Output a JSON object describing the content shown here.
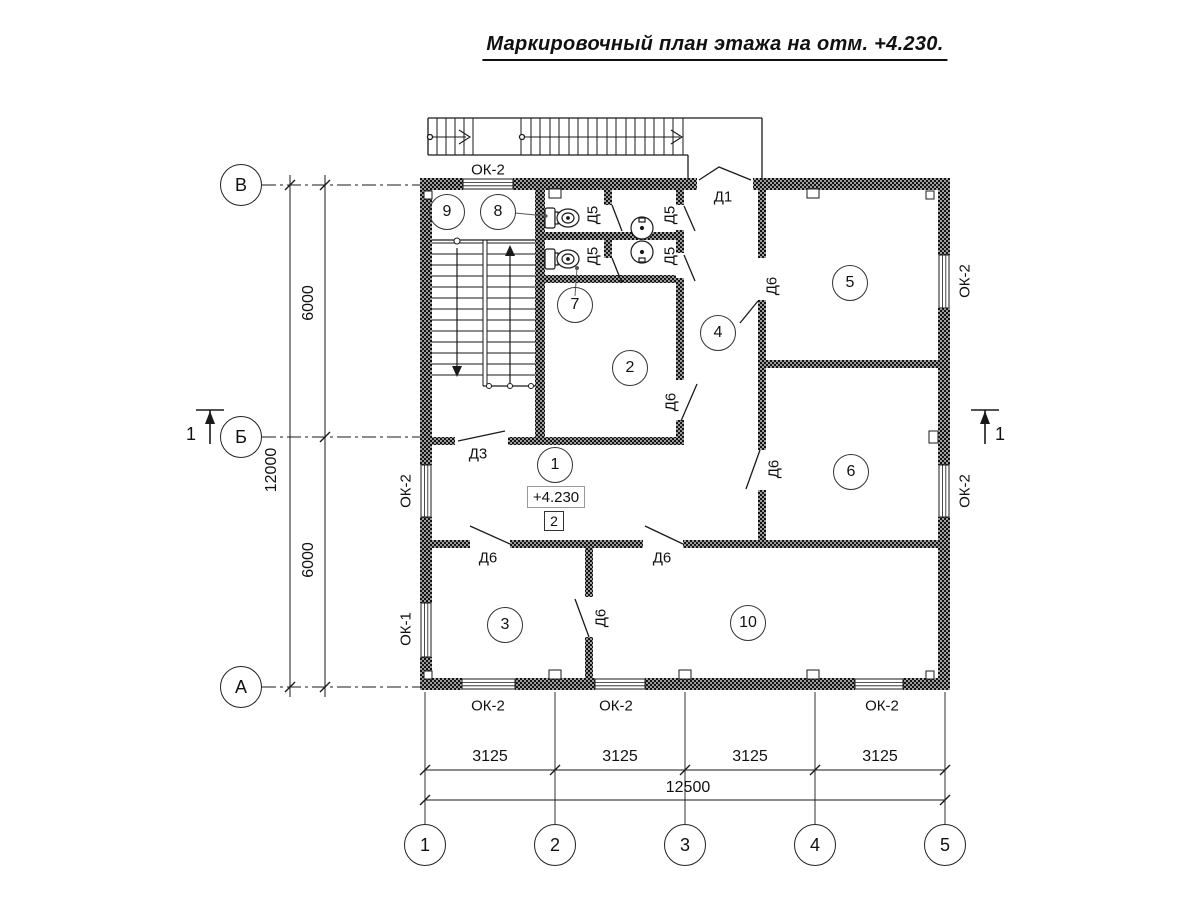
{
  "title": "Маркировочный план этажа на отм. +4.230.",
  "elevation_box": "+4.230",
  "zone_box": "2",
  "rooms": [
    {
      "name": "room-circle-1",
      "number": "1",
      "x": 555,
      "y": 465
    },
    {
      "name": "room-circle-2",
      "number": "2",
      "x": 630,
      "y": 368
    },
    {
      "name": "room-circle-3",
      "number": "3",
      "x": 505,
      "y": 625
    },
    {
      "name": "room-circle-4",
      "number": "4",
      "x": 718,
      "y": 333
    },
    {
      "name": "room-circle-5",
      "number": "5",
      "x": 850,
      "y": 283
    },
    {
      "name": "room-circle-6",
      "number": "6",
      "x": 851,
      "y": 472
    },
    {
      "name": "room-circle-7",
      "number": "7",
      "x": 575,
      "y": 305
    },
    {
      "name": "room-circle-8",
      "number": "8",
      "x": 498,
      "y": 212
    },
    {
      "name": "room-circle-9",
      "number": "9",
      "x": 447,
      "y": 212
    },
    {
      "name": "room-circle-10",
      "number": "10",
      "x": 748,
      "y": 623
    }
  ],
  "axes_left": [
    {
      "name": "axis-circle-v",
      "label": "В",
      "x": 241,
      "y": 185
    },
    {
      "name": "axis-circle-b",
      "label": "Б",
      "x": 241,
      "y": 437
    },
    {
      "name": "axis-circle-a",
      "label": "А",
      "x": 241,
      "y": 687
    }
  ],
  "axes_bottom": [
    {
      "name": "axis-circle-1",
      "label": "1",
      "x": 425,
      "y": 845
    },
    {
      "name": "axis-circle-2",
      "label": "2",
      "x": 555,
      "y": 845
    },
    {
      "name": "axis-circle-3",
      "label": "3",
      "x": 685,
      "y": 845
    },
    {
      "name": "axis-circle-4",
      "label": "4",
      "x": 815,
      "y": 845
    },
    {
      "name": "axis-circle-5",
      "label": "5",
      "x": 945,
      "y": 845
    }
  ],
  "labels": [
    {
      "name": "window-label-ok2-top",
      "text": "ОК-2",
      "x": 488,
      "y": 170,
      "rot": 0,
      "cls": ""
    },
    {
      "name": "window-label-ok2-left",
      "text": "ОК-2",
      "x": 406,
      "y": 491,
      "rot": -90,
      "cls": ""
    },
    {
      "name": "window-label-ok1-left",
      "text": "ОК-1",
      "x": 406,
      "y": 629,
      "rot": -90,
      "cls": ""
    },
    {
      "name": "window-label-ok2-right-upper",
      "text": "ОК-2",
      "x": 965,
      "y": 281,
      "rot": -90,
      "cls": ""
    },
    {
      "name": "window-label-ok2-right-lower",
      "text": "ОК-2",
      "x": 965,
      "y": 491,
      "rot": -90,
      "cls": ""
    },
    {
      "name": "window-label-ok2-bottom-1",
      "text": "ОК-2",
      "x": 488,
      "y": 706,
      "rot": 0,
      "cls": ""
    },
    {
      "name": "window-label-ok2-bottom-2",
      "text": "ОК-2",
      "x": 616,
      "y": 706,
      "rot": 0,
      "cls": ""
    },
    {
      "name": "window-label-ok2-bottom-3",
      "text": "ОК-2",
      "x": 882,
      "y": 706,
      "rot": 0,
      "cls": ""
    },
    {
      "name": "door-label-d1",
      "text": "Д1",
      "x": 723,
      "y": 197,
      "rot": 0,
      "cls": ""
    },
    {
      "name": "door-label-d3",
      "text": "Д3",
      "x": 478,
      "y": 454,
      "rot": 0,
      "cls": ""
    },
    {
      "name": "door-label-d5-1",
      "text": "Д5",
      "x": 593,
      "y": 215,
      "rot": -90,
      "cls": ""
    },
    {
      "name": "door-label-d5-2",
      "text": "Д5",
      "x": 670,
      "y": 215,
      "rot": -90,
      "cls": ""
    },
    {
      "name": "door-label-d5-3",
      "text": "Д5",
      "x": 593,
      "y": 256,
      "rot": -90,
      "cls": ""
    },
    {
      "name": "door-label-d5-4",
      "text": "Д5",
      "x": 670,
      "y": 256,
      "rot": -90,
      "cls": ""
    },
    {
      "name": "door-label-d6-corridor",
      "text": "Д6",
      "x": 772,
      "y": 286,
      "rot": -90,
      "cls": ""
    },
    {
      "name": "door-label-d6-room2",
      "text": "Д6",
      "x": 671,
      "y": 402,
      "rot": -90,
      "cls": ""
    },
    {
      "name": "door-label-d6-room6",
      "text": "Д6",
      "x": 774,
      "y": 469,
      "rot": -90,
      "cls": ""
    },
    {
      "name": "door-label-d6-hall-left",
      "text": "Д6",
      "x": 488,
      "y": 558,
      "rot": 0,
      "cls": ""
    },
    {
      "name": "door-label-d6-hall-right",
      "text": "Д6",
      "x": 662,
      "y": 558,
      "rot": 0,
      "cls": ""
    },
    {
      "name": "door-label-d6-room3-10",
      "text": "Д6",
      "x": 601,
      "y": 618,
      "rot": -90,
      "cls": ""
    },
    {
      "name": "dim-label-6000-upper",
      "text": "6000",
      "x": 309,
      "y": 303,
      "rot": -90,
      "cls": "dim"
    },
    {
      "name": "dim-label-6000-lower",
      "text": "6000",
      "x": 309,
      "y": 560,
      "rot": -90,
      "cls": "dim"
    },
    {
      "name": "dim-label-12000",
      "text": "12000",
      "x": 272,
      "y": 470,
      "rot": -90,
      "cls": "dim"
    },
    {
      "name": "dim-label-3125-1",
      "text": "3125",
      "x": 490,
      "y": 757,
      "rot": 0,
      "cls": "dim"
    },
    {
      "name": "dim-label-3125-2",
      "text": "3125",
      "x": 620,
      "y": 757,
      "rot": 0,
      "cls": "dim"
    },
    {
      "name": "dim-label-3125-3",
      "text": "3125",
      "x": 750,
      "y": 757,
      "rot": 0,
      "cls": "dim"
    },
    {
      "name": "dim-label-3125-4",
      "text": "3125",
      "x": 880,
      "y": 757,
      "rot": 0,
      "cls": "dim"
    },
    {
      "name": "dim-label-12500",
      "text": "12500",
      "x": 688,
      "y": 788,
      "rot": 0,
      "cls": "dim"
    },
    {
      "name": "section-label-left",
      "text": "1",
      "x": 191,
      "y": 434,
      "rot": 0,
      "cls": "sec"
    },
    {
      "name": "section-label-right",
      "text": "1",
      "x": 1000,
      "y": 434,
      "rot": 0,
      "cls": "sec"
    }
  ]
}
